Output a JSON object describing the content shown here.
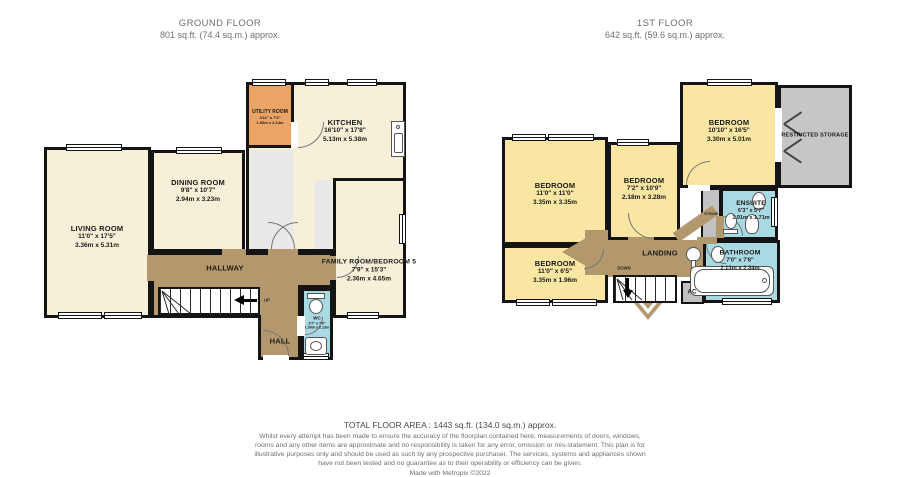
{
  "ground": {
    "title": "GROUND FLOOR",
    "subtitle": "801 sq.ft. (74.4 sq.m.) approx.",
    "rooms": {
      "living": {
        "name": "LIVING ROOM",
        "dims_ft": "11'0\" x 17'5\"",
        "dims_m": "3.36m x 5.31m"
      },
      "dining": {
        "name": "DINING ROOM",
        "dims_ft": "9'8\" x 10'7\"",
        "dims_m": "2.94m x 3.23m"
      },
      "utility": {
        "name": "UTILITY ROOM",
        "dims_ft": "4'11\" x 7'0\"",
        "dims_m": "1.50m x 2.14m"
      },
      "kitchen": {
        "name": "KITCHEN",
        "dims_ft": "16'10\" x 17'8\"",
        "dims_m": "5.13m x 5.38m"
      },
      "family": {
        "name": "FAMILY ROOM/BEDROOM 5",
        "dims_ft": "7'9\" x 15'3\"",
        "dims_m": "2.36m x 4.65m"
      },
      "hallway": {
        "name": "HALLWAY"
      },
      "hall": {
        "name": "HALL"
      },
      "wc": {
        "name": "WC",
        "dims_ft": "3'7\" x 7'0\"",
        "dims_m": "1.09m x 2.13m"
      },
      "up": "UP"
    }
  },
  "first": {
    "title": "1ST FLOOR",
    "subtitle": "642 sq.ft. (59.6 sq.m.) approx.",
    "rooms": {
      "bedroom1": {
        "name": "BEDROOM",
        "dims_ft": "11'0\" x 11'0\"",
        "dims_m": "3.35m x 3.35m"
      },
      "bedroom2": {
        "name": "BEDROOM",
        "dims_ft": "7'2\" x 10'9\"",
        "dims_m": "2.18m x 3.28m"
      },
      "bedroom3": {
        "name": "BEDROOM",
        "dims_ft": "10'10\" x 16'5\"",
        "dims_m": "3.30m x 5.01m"
      },
      "bedroom4": {
        "name": "BEDROOM",
        "dims_ft": "11'0\" x 6'5\"",
        "dims_m": "3.35m x 1.96m"
      },
      "restricted": {
        "name": "RESTRICTED STORAGE"
      },
      "landing": {
        "name": "LANDING"
      },
      "storage": {
        "name": "STORAGE"
      },
      "ensuite": {
        "name": "ENSUITE",
        "dims_ft": "6'3\" x 5'7\"",
        "dims_m": "1.91m x 1.71m"
      },
      "bathroom": {
        "name": "BATHROOM",
        "dims_ft": "7'0\" x 7'8\"",
        "dims_m": "2.13m x 2.34m"
      },
      "ac": {
        "name": "AC"
      },
      "down": "DOWN"
    }
  },
  "footer": {
    "total": "TOTAL FLOOR AREA : 1443 sq.ft. (134.0 sq.m.) approx.",
    "disclaimer": "Whilst every attempt has been made to ensure the accuracy of the floorplan contained here, measurements of doors, windows, rooms and any other items are approximate and no responsibility is taken for any error, omission or mis-statement. This plan is for illustrative purposes only and should be used as such by any prospective purchaser. The services, systems and appliances shown have not been tested and no guarantee as to their operability or efficiency can be given.",
    "credit": "Made with Metropix ©2022"
  },
  "colors": {
    "room_cream": "#f6f0d8",
    "room_yellow": "#f8e6a2",
    "utility_orange": "#e9a466",
    "hall_brown": "#b3986d",
    "bath_blue": "#a9d9e3",
    "storage_gray": "#c6c6c6",
    "wall": "#141414"
  }
}
